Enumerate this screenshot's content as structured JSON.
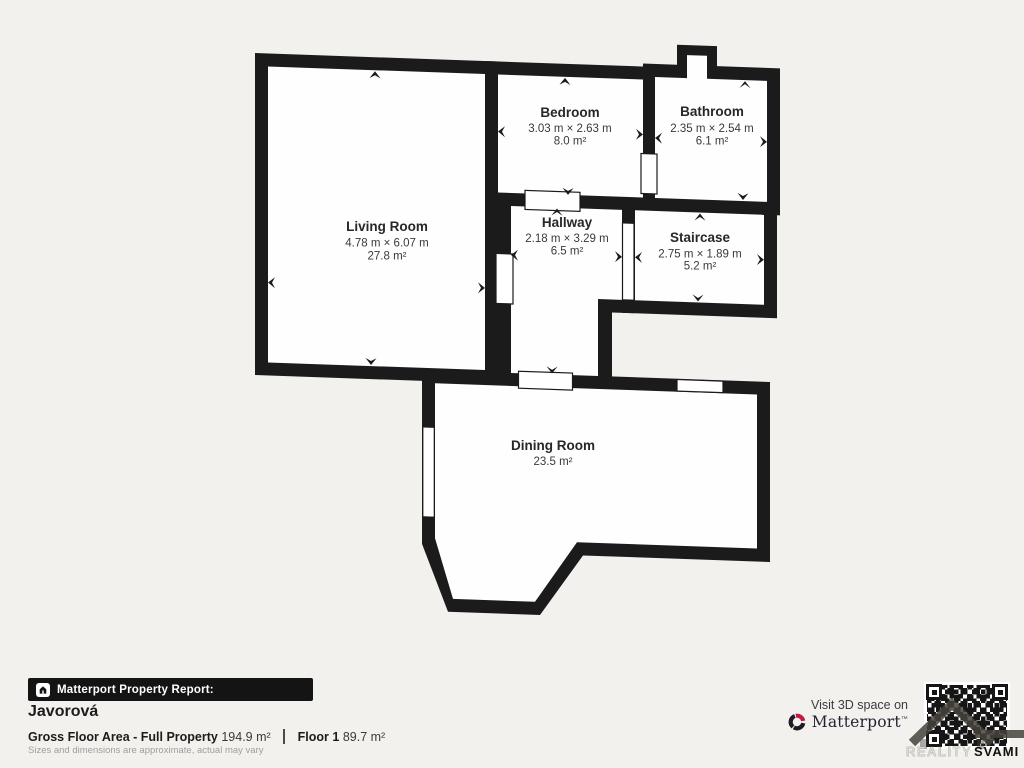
{
  "plan": {
    "rooms": [
      {
        "name": "Living Room",
        "dims": "4.78 m × 6.07 m",
        "area": "27.8 m²"
      },
      {
        "name": "Bedroom",
        "dims": "3.03 m × 2.63 m",
        "area": "8.0 m²"
      },
      {
        "name": "Bathroom",
        "dims": "2.35 m × 2.54 m",
        "area": "6.1 m²"
      },
      {
        "name": "Hallway",
        "dims": "2.18 m × 3.29 m",
        "area": "6.5 m²"
      },
      {
        "name": "Staircase",
        "dims": "2.75 m × 1.89 m",
        "area": "5.2 m²"
      },
      {
        "name": "Dining Room",
        "area": "23.5 m²"
      }
    ],
    "colors": {
      "wall": "#1b1b1b",
      "floor": "#ffffff",
      "background": "#f2f1ee"
    }
  },
  "footer": {
    "report_badge": "Matterport Property Report:",
    "property_name": "Javorová",
    "gross_label": "Gross Floor Area - Full Property",
    "gross_value": "194.9 m²",
    "floor_label": "Floor 1",
    "floor_value": "89.7 m²",
    "disclaimer": "Sizes and dimensions are approximate, actual may vary",
    "visit_text": "Visit 3D space on",
    "brand": "Matterport",
    "brand_mark": "™",
    "watermark_reality": "REALITY",
    "watermark_svami": "SVAMI"
  }
}
